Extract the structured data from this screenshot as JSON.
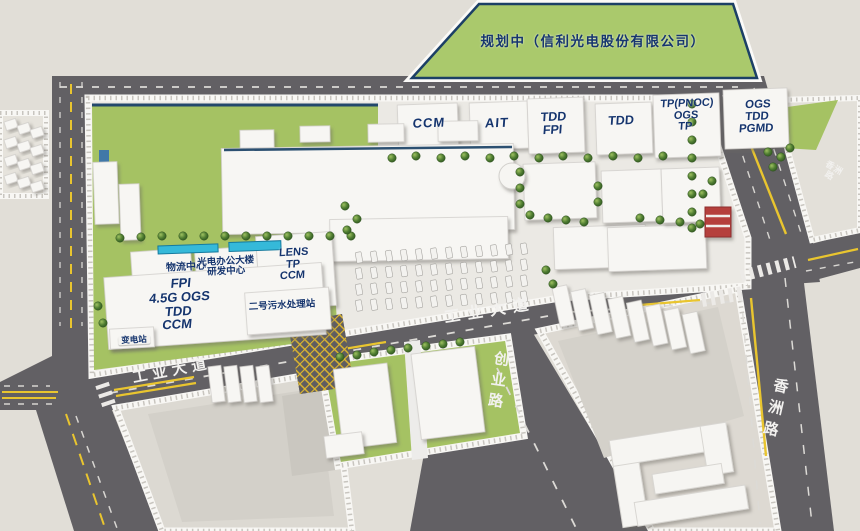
{
  "map": {
    "planned_area": "规划中（信利光电股份有限公司）",
    "factories": {
      "ccm": "CCM",
      "ait": "AIT",
      "tdd_fpi": "TDD\nFPI",
      "tdd": "TDD",
      "tp_pnoc": "TP(PNOC)\nOGS\nTP",
      "ogs_tdd_pgmd": "OGS\nTDD\nPGMD"
    },
    "campus": {
      "logistics": "物流中心",
      "office": "光电办公大楼\n研发中心",
      "fpi_stack": "FPI\n4.5G OGS\nTDD\nCCM",
      "lens_stack": "LENS\nTP\nCCM",
      "sewage": "二号污水处理站",
      "substation": "变电站"
    },
    "roads": {
      "industrial_west": "工业大道",
      "industrial_center": "工业大道",
      "chuangye": "创业路",
      "xiangzhou": "香洲路",
      "xiangzhou_north": "香洲路"
    },
    "colors": {
      "ground": "#e1ded7",
      "road": "#626064",
      "green": "#a5c263",
      "planned_green": "#aac96c",
      "building": "#f6f5f2",
      "label_navy": "#16356e",
      "road_text": "#f2f1ef",
      "line_yellow": "#e9c52f",
      "canopy_cyan": "#35b9d9",
      "accent_red": "#b5403e"
    }
  }
}
